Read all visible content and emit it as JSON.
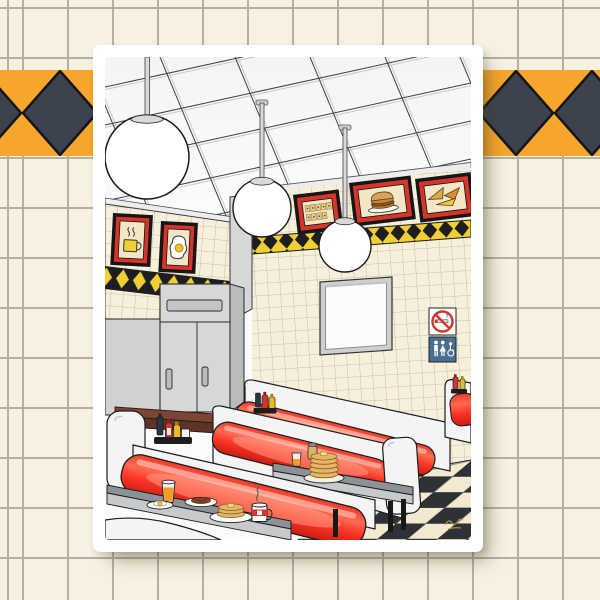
{
  "artwork": {
    "subject": "Retro diner interior illustration art print",
    "signature": "illegible gold artist signature scribble, bottom right of print",
    "wall_art": [
      {
        "label": "coffee cup picture",
        "wall": "left soffit"
      },
      {
        "label": "fried egg picture",
        "wall": "left soffit"
      },
      {
        "label": "menu letter board picture",
        "wall": "back wall"
      },
      {
        "label": "burger picture",
        "wall": "back wall"
      },
      {
        "label": "pizza slices picture",
        "wall": "back wall"
      },
      {
        "label": "blank menu board",
        "wall": "back wall"
      }
    ],
    "signs": [
      "no smoking sign",
      "restroom sign"
    ],
    "furniture": [
      "three globe pendant lights",
      "drop tile ceiling",
      "red vinyl booth rows",
      "gray tables with black legs",
      "gray service cabinet",
      "brown counter",
      "black and cream checkerboard floor"
    ],
    "table_items": [
      "orange juice glass",
      "fried egg plate",
      "steak plate",
      "pancake plate",
      "coffee mug with steam",
      "pancake stack with butter",
      "syrup jar",
      "juice glass",
      "ketchup bottles",
      "mustard bottles",
      "napkin holder",
      "dark sauce bottles"
    ]
  },
  "background": {
    "pattern": "cream square tile grid",
    "band": "orange horizontal band with dark diamonds"
  },
  "colors": {
    "background_tile": "#f7f1e1",
    "background_line": "#b6b0a3",
    "band_orange": "#f6a62b",
    "band_diamond": "#3d434e",
    "poster_white": "#ffffff",
    "ceiling_white": "#fbfbfb",
    "wall_cream": "#f6efdb",
    "wall_line": "#c9bfa4",
    "stripe_yellow": "#f0cf35",
    "stripe_black": "#1d1e22",
    "accent_red": "#d6352b",
    "frame_black": "#17171a",
    "cushion_red": "#f0372a",
    "booth_shell": "#f4f4f4",
    "table_gray": "#8d9298",
    "table_skirt": "#c7cacd",
    "cabinet_gray": "#d5d7d9",
    "cabinet_side": "#b9bbbe",
    "counter_brown": "#7c4433",
    "floor_cream": "#f2e9d0",
    "floor_black": "#2e3237",
    "baseboard_gray": "#9ba0a6",
    "sign_blue": "#4a6d92",
    "sign_red": "#d1342c",
    "juice_orange": "#f49b20",
    "pancake_tan": "#e3b668",
    "steak_brown": "#8a4a32",
    "mug_yellow": "#f2cf35",
    "signature_gold": "#c29a3a"
  }
}
